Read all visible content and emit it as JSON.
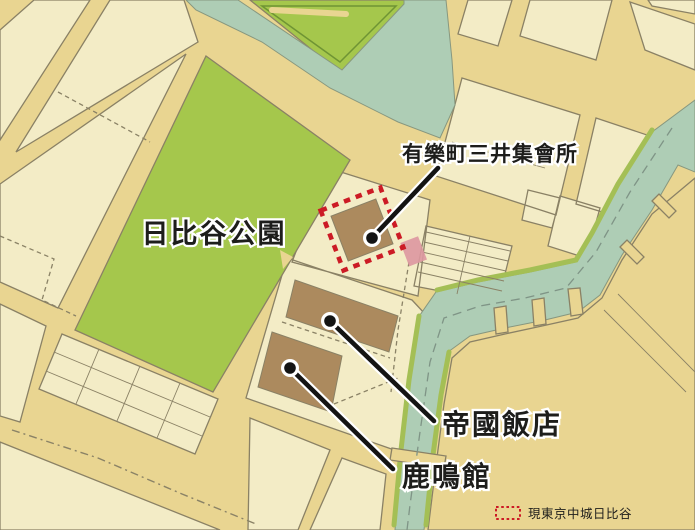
{
  "labels": {
    "park": "日比谷公園",
    "mitsui_hall": "有樂町三井集會所",
    "imperial_hotel": "帝國飯店",
    "rokumeikan": "鹿鳴館"
  },
  "legend": {
    "label": "現東京中城日比谷",
    "swatch": "red-dashed-rectangle"
  },
  "colors": {
    "road_background": "#e9d591",
    "city_block": "#f3ecc6",
    "park_green": "#a5c74c",
    "water_teal": "#aecdb5",
    "bank_green": "#a4bf55",
    "building_brown": "#ac8a5e",
    "highlight_red": "#cc1b25",
    "highlight_pink": "#dd97a0",
    "outline_gray": "#8a8165",
    "park_label_green": "#4f9a44",
    "label_black": "#1d1d1b"
  }
}
